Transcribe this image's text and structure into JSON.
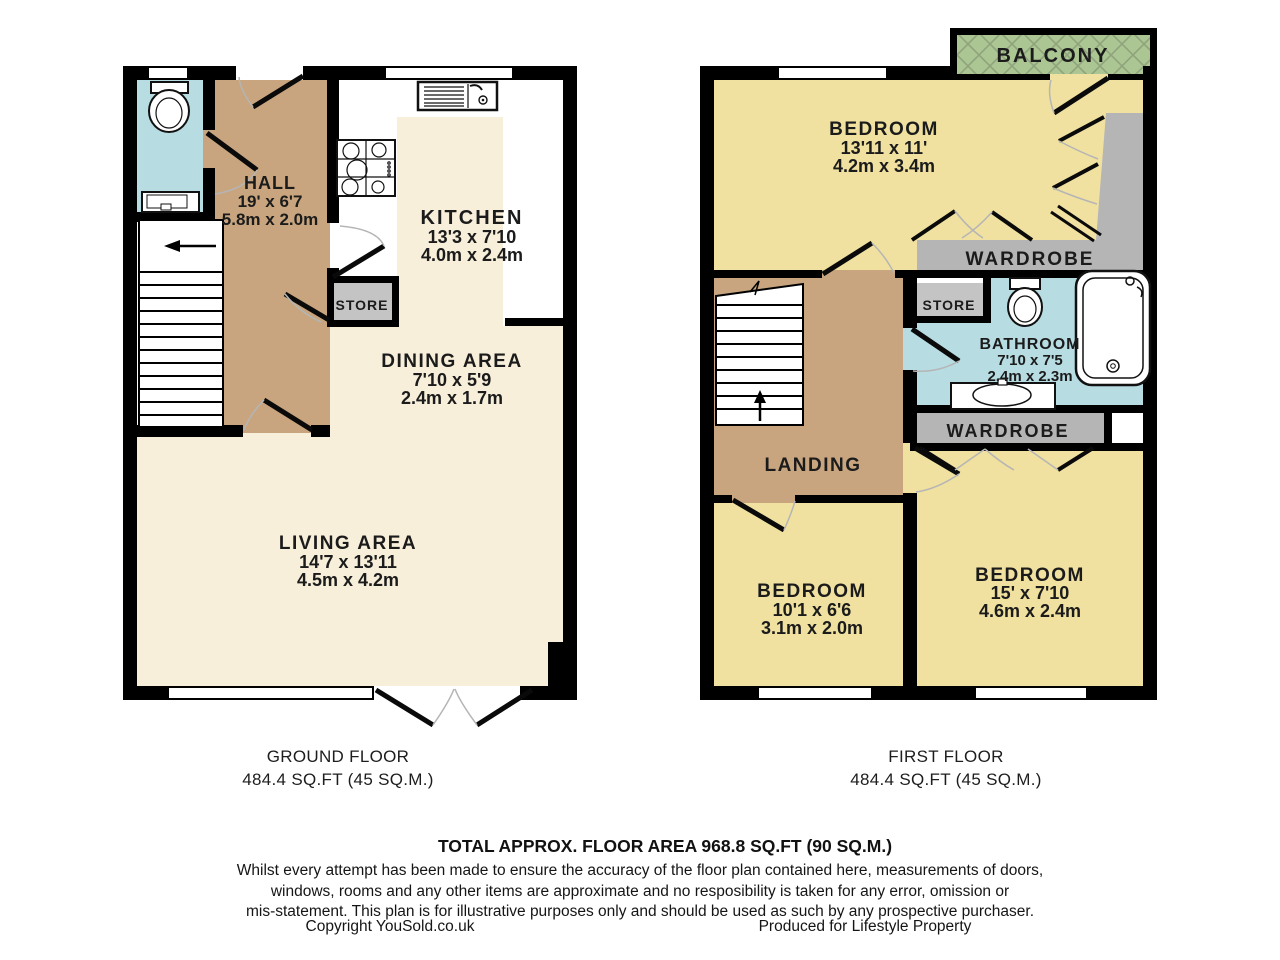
{
  "colors": {
    "wall": "#000000",
    "floor_cream": "#f8efdb",
    "floor_tan": "#c8a57e",
    "floor_yellow": "#f0e1a0",
    "floor_blue": "#b7dce2",
    "balcony_green": "#abc693",
    "wardrobe_gray": "#b5b5b5",
    "store_gray": "#c4c4c4",
    "kitchen_white": "#ffffff"
  },
  "ground_floor": {
    "caption_line1": "GROUND FLOOR",
    "caption_line2": "484.4 SQ.FT (45 SQ.M.)",
    "hall": {
      "name": "HALL",
      "ft": "19' x 6'7",
      "m": "5.8m x 2.0m"
    },
    "kitchen": {
      "name": "KITCHEN",
      "ft": "13'3 x 7'10",
      "m": "4.0m x 2.4m"
    },
    "dining": {
      "name": "DINING AREA",
      "ft": "7'10 x 5'9",
      "m": "2.4m x 1.7m"
    },
    "living": {
      "name": "LIVING AREA",
      "ft": "14'7 x 13'11",
      "m": "4.5m x 4.2m"
    },
    "store": {
      "name": "STORE"
    }
  },
  "first_floor": {
    "caption_line1": "FIRST FLOOR",
    "caption_line2": "484.4 SQ.FT (45 SQ.M.)",
    "balcony": {
      "name": "BALCONY"
    },
    "bedroom1": {
      "name": "BEDROOM",
      "ft": "13'11 x 11'",
      "m": "4.2m x 3.4m"
    },
    "wardrobe1": {
      "name": "WARDROBE"
    },
    "store": {
      "name": "STORE"
    },
    "bathroom": {
      "name": "BATHROOM",
      "ft": "7'10 x 7'5",
      "m": "2.4m x 2.3m"
    },
    "wardrobe2": {
      "name": "WARDROBE"
    },
    "landing": {
      "name": "LANDING"
    },
    "bedroom2": {
      "name": "BEDROOM",
      "ft": "10'1 x 6'6",
      "m": "3.1m x 2.0m"
    },
    "bedroom3": {
      "name": "BEDROOM",
      "ft": "15' x 7'10",
      "m": "4.6m x 2.4m"
    }
  },
  "footer": {
    "total": "TOTAL APPROX. FLOOR AREA 968.8 SQ.FT (90 SQ.M.)",
    "disclaimer_lines": [
      "Whilst every attempt has been made to ensure the accuracy of the floor plan contained here, measurements of doors,",
      "windows, rooms and any other items are approximate and no resposibility is taken for any error, omission or",
      "mis-statement. This plan is for illustrative purposes only and should be used as such by any prospective purchaser."
    ],
    "copyright": "Copyright YouSold.co.uk",
    "produced": "Produced for Lifestyle Property"
  }
}
